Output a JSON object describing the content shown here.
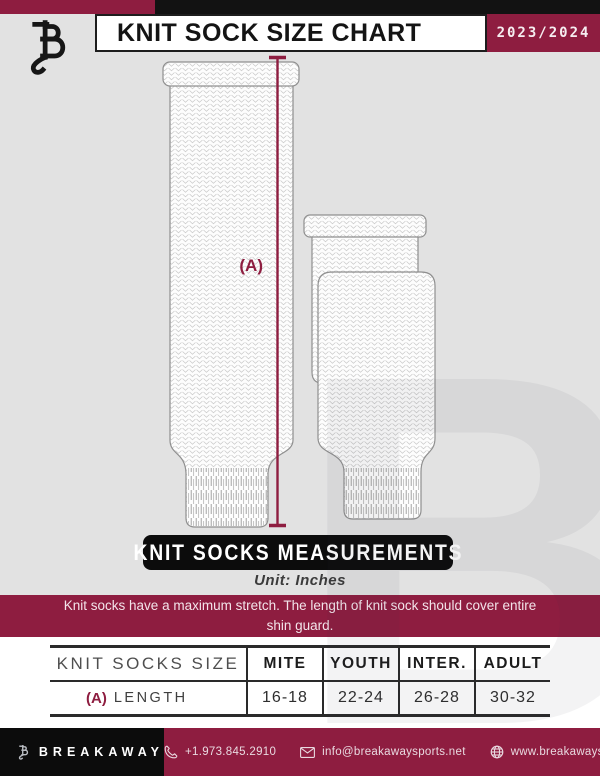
{
  "header": {
    "title": "KNIT SOCK SIZE CHART",
    "season": "2023/2024"
  },
  "diagram": {
    "measurement_label": "(A)"
  },
  "measurements": {
    "heading": "KNIT SOCKS MEASUREMENTS",
    "unit": "Unit: Inches"
  },
  "banner": {
    "note": "Knit socks have a maximum stretch. The length of knit sock should cover entire shin guard."
  },
  "table": {
    "header": [
      "KNIT SOCKS SIZE",
      "MITE",
      "YOUTH",
      "INTER.",
      "ADULT"
    ],
    "rows": [
      {
        "key": "(A)",
        "label": "LENGTH",
        "values": [
          "16-18",
          "22-24",
          "26-28",
          "30-32"
        ]
      }
    ]
  },
  "footer": {
    "brand": "BREAKAWAY",
    "phone": "+1.973.845.2910",
    "email": "info@breakawaysports.net",
    "website": "www.breakawaysports.net"
  },
  "colors": {
    "accent_maroon": "#8e1d40",
    "black": "#121212",
    "background_gray": "#e2e2e2"
  },
  "icons": {
    "brand_logo": "breakaway-b-with-hockey-stick",
    "phone": "phone-icon",
    "email": "envelope-icon",
    "website": "globe-icon"
  }
}
